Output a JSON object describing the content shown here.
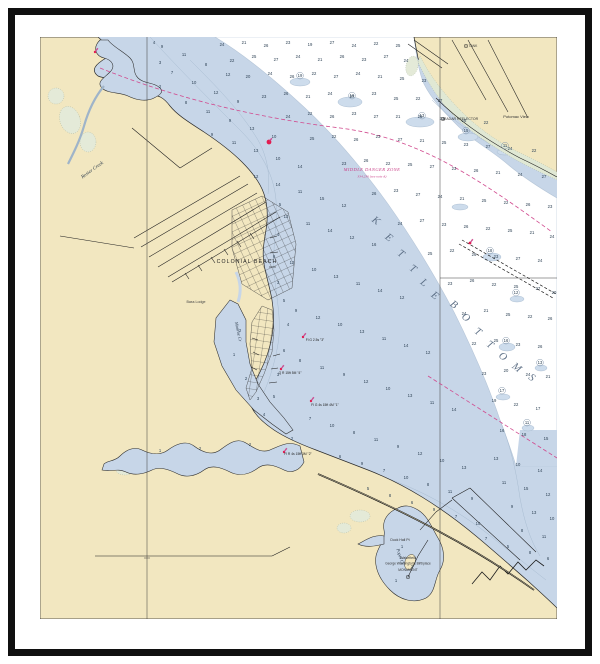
{
  "print": {
    "frame_color": "#101010",
    "mat_color": "#ffffff",
    "land_color": "#f2e7c0",
    "shallow_water_color": "#c7d6e8",
    "deep_water_color": "#ffffff",
    "marsh_color": "#e0e8d4",
    "magenta": "#c93f87",
    "red_aid": "#e31c4e"
  },
  "chart": {
    "labels": [
      {
        "t": "Rosier Creek",
        "x": 93,
        "y": 171,
        "r": -36,
        "s": 5,
        "c": "#2b3a4a",
        "f": "serif-i"
      },
      {
        "t": "COLONIAL BEACH",
        "x": 247,
        "y": 263,
        "r": 0,
        "s": 5.2,
        "c": "#222222",
        "f": "sans",
        "sp": 1.1
      },
      {
        "t": "Monroe Cr",
        "x": 237,
        "y": 332,
        "r": 78,
        "s": 4.5,
        "c": "#2b3a4a",
        "f": "serif-i"
      },
      {
        "t": "Bass Lodge",
        "x": 196,
        "y": 303,
        "r": 0,
        "s": 3.6,
        "c": "#444444",
        "f": "sans"
      },
      {
        "t": "MIDDLE DANGER ZONE",
        "x": 372,
        "y": 171,
        "r": 0,
        "s": 4.6,
        "c": "#c93f87",
        "f": "serif-i",
        "sp": 0.4
      },
      {
        "t": "334.230 (see note A)",
        "x": 372,
        "y": 177.5,
        "r": 0,
        "s": 3.5,
        "c": "#c93f87",
        "f": "serif-i"
      },
      {
        "t": "RADAR REFLECTOR",
        "x": 461,
        "y": 120,
        "r": 0,
        "s": 3.5,
        "c": "#333333",
        "f": "sans"
      },
      {
        "t": "Potomac View",
        "x": 516,
        "y": 118,
        "r": 0,
        "s": 4,
        "c": "#333333",
        "f": "sans"
      },
      {
        "t": "TANK",
        "x": 473,
        "y": 47,
        "r": 0,
        "s": 3.3,
        "c": "#333333",
        "f": "sans"
      },
      {
        "t": "Duck Hall Pt",
        "x": 400,
        "y": 541,
        "r": 0,
        "s": 3.5,
        "c": "#333333",
        "f": "sans"
      },
      {
        "t": "Wakefield",
        "x": 408,
        "y": 559,
        "r": 0,
        "s": 3.7,
        "c": "#333333",
        "f": "sans"
      },
      {
        "t": "George Washington's Birthplace",
        "x": 408,
        "y": 564.5,
        "r": 0,
        "s": 3.2,
        "c": "#333333",
        "f": "sans"
      },
      {
        "t": "MONUMENT",
        "x": 408,
        "y": 571,
        "r": 0,
        "s": 3.3,
        "c": "#333333",
        "f": "sans"
      },
      {
        "t": "Popes Cr",
        "x": 399,
        "y": 557,
        "r": 72,
        "s": 4.4,
        "c": "#2b3a4a",
        "f": "serif-i"
      },
      {
        "t": "Q R 15ft 5M \"4\"",
        "x": 290,
        "y": 374,
        "r": 0,
        "s": 3.3,
        "c": "#222222",
        "f": "sans"
      },
      {
        "t": "Fl G 4s 15ft 4M \"1\"",
        "x": 325,
        "y": 406,
        "r": 0,
        "s": 3.3,
        "c": "#222222",
        "f": "sans"
      },
      {
        "t": "Fl R 4s 15ft 3M \"2\"",
        "x": 298,
        "y": 455,
        "r": 0,
        "s": 3.3,
        "c": "#222222",
        "f": "sans"
      },
      {
        "t": "Fl G 2.5s \"3\"",
        "x": 315,
        "y": 341,
        "r": 0,
        "s": 3.3,
        "c": "#222222",
        "f": "sans"
      }
    ],
    "kettle": {
      "text": "KETTLE BOTTOMS",
      "size": 10.5,
      "rot": 38,
      "color": "#54677e",
      "letters": [
        [
          "K",
          374,
          223
        ],
        [
          "E",
          387,
          240
        ],
        [
          "T",
          399,
          256
        ],
        [
          "T",
          411,
          271
        ],
        [
          "L",
          422,
          285
        ],
        [
          "E",
          433,
          298
        ],
        [
          "B",
          452,
          307
        ],
        [
          "O",
          464,
          320
        ],
        [
          "T",
          476,
          334
        ],
        [
          "T",
          488,
          347
        ],
        [
          "O",
          501,
          359
        ],
        [
          "M",
          515,
          370
        ],
        [
          "S",
          530,
          380
        ]
      ]
    },
    "soundings": [
      [
        222,
        46,
        "24"
      ],
      [
        244,
        44,
        "21"
      ],
      [
        266,
        47,
        "26"
      ],
      [
        288,
        44,
        "23"
      ],
      [
        310,
        46,
        "19"
      ],
      [
        332,
        44,
        "27"
      ],
      [
        354,
        47,
        "24"
      ],
      [
        376,
        45,
        "22"
      ],
      [
        398,
        47,
        "25"
      ],
      [
        232,
        62,
        "22"
      ],
      [
        254,
        58,
        "25"
      ],
      [
        276,
        61,
        "27"
      ],
      [
        298,
        58,
        "24"
      ],
      [
        320,
        61,
        "21"
      ],
      [
        342,
        58,
        "26"
      ],
      [
        364,
        61,
        "23"
      ],
      [
        386,
        58,
        "27"
      ],
      [
        406,
        62,
        "24"
      ],
      [
        248,
        78,
        "20"
      ],
      [
        270,
        75,
        "24"
      ],
      [
        292,
        78,
        "26"
      ],
      [
        314,
        75,
        "22"
      ],
      [
        336,
        78,
        "27"
      ],
      [
        358,
        75,
        "24"
      ],
      [
        380,
        78,
        "21"
      ],
      [
        402,
        80,
        "25"
      ],
      [
        424,
        82,
        "23"
      ],
      [
        264,
        98,
        "23"
      ],
      [
        286,
        95,
        "26"
      ],
      [
        308,
        98,
        "21"
      ],
      [
        330,
        95,
        "24"
      ],
      [
        352,
        98,
        "27"
      ],
      [
        374,
        95,
        "23"
      ],
      [
        396,
        100,
        "25"
      ],
      [
        418,
        100,
        "22"
      ],
      [
        440,
        102,
        "27"
      ],
      [
        288,
        118,
        "24"
      ],
      [
        310,
        115,
        "22"
      ],
      [
        332,
        118,
        "26"
      ],
      [
        354,
        115,
        "23"
      ],
      [
        376,
        118,
        "27"
      ],
      [
        398,
        118,
        "21"
      ],
      [
        420,
        118,
        "25"
      ],
      [
        442,
        120,
        "23"
      ],
      [
        464,
        122,
        "26"
      ],
      [
        486,
        124,
        "22"
      ],
      [
        312,
        140,
        "25"
      ],
      [
        334,
        138,
        "22"
      ],
      [
        356,
        141,
        "26"
      ],
      [
        378,
        138,
        "23"
      ],
      [
        400,
        141,
        "27"
      ],
      [
        422,
        142,
        "21"
      ],
      [
        444,
        144,
        "25"
      ],
      [
        466,
        146,
        "23"
      ],
      [
        488,
        148,
        "27"
      ],
      [
        510,
        150,
        "24"
      ],
      [
        534,
        152,
        "22"
      ],
      [
        344,
        165,
        "23"
      ],
      [
        366,
        162,
        "26"
      ],
      [
        388,
        165,
        "22"
      ],
      [
        410,
        166,
        "25"
      ],
      [
        432,
        168,
        "27"
      ],
      [
        454,
        170,
        "23"
      ],
      [
        476,
        172,
        "26"
      ],
      [
        498,
        174,
        "21"
      ],
      [
        520,
        176,
        "24"
      ],
      [
        544,
        178,
        "27"
      ],
      [
        374,
        195,
        "26"
      ],
      [
        396,
        192,
        "23"
      ],
      [
        418,
        196,
        "27"
      ],
      [
        440,
        198,
        "24"
      ],
      [
        462,
        200,
        "21"
      ],
      [
        484,
        202,
        "25"
      ],
      [
        506,
        204,
        "22"
      ],
      [
        528,
        206,
        "26"
      ],
      [
        550,
        208,
        "23"
      ],
      [
        400,
        225,
        "24"
      ],
      [
        422,
        222,
        "27"
      ],
      [
        444,
        226,
        "23"
      ],
      [
        466,
        228,
        "26"
      ],
      [
        488,
        230,
        "22"
      ],
      [
        510,
        232,
        "25"
      ],
      [
        532,
        234,
        "21"
      ],
      [
        552,
        238,
        "24"
      ],
      [
        430,
        255,
        "25"
      ],
      [
        452,
        252,
        "22"
      ],
      [
        474,
        256,
        "26"
      ],
      [
        496,
        258,
        "23"
      ],
      [
        518,
        260,
        "27"
      ],
      [
        540,
        262,
        "24"
      ],
      [
        450,
        285,
        "23"
      ],
      [
        472,
        282,
        "26"
      ],
      [
        494,
        286,
        "22"
      ],
      [
        516,
        288,
        "25"
      ],
      [
        538,
        290,
        "27"
      ],
      [
        554,
        294,
        "20"
      ],
      [
        464,
        315,
        "24"
      ],
      [
        486,
        312,
        "21"
      ],
      [
        508,
        316,
        "25"
      ],
      [
        530,
        318,
        "22"
      ],
      [
        550,
        320,
        "26"
      ],
      [
        474,
        345,
        "22"
      ],
      [
        496,
        342,
        "25"
      ],
      [
        518,
        346,
        "23"
      ],
      [
        540,
        348,
        "26"
      ],
      [
        484,
        375,
        "23"
      ],
      [
        506,
        372,
        "20"
      ],
      [
        528,
        376,
        "24"
      ],
      [
        548,
        378,
        "21"
      ],
      [
        494,
        402,
        "19"
      ],
      [
        516,
        406,
        "22"
      ],
      [
        538,
        410,
        "17"
      ],
      [
        502,
        432,
        "16"
      ],
      [
        524,
        436,
        "18"
      ],
      [
        546,
        440,
        "15"
      ],
      [
        162,
        48,
        "9"
      ],
      [
        184,
        56,
        "11"
      ],
      [
        206,
        66,
        "8"
      ],
      [
        228,
        76,
        "12"
      ],
      [
        172,
        74,
        "7"
      ],
      [
        194,
        84,
        "10"
      ],
      [
        216,
        94,
        "12"
      ],
      [
        238,
        103,
        "9"
      ],
      [
        186,
        104,
        "8"
      ],
      [
        208,
        113,
        "11"
      ],
      [
        230,
        122,
        "9"
      ],
      [
        252,
        130,
        "13"
      ],
      [
        274,
        138,
        "10"
      ],
      [
        212,
        136,
        "9"
      ],
      [
        234,
        144,
        "11"
      ],
      [
        256,
        152,
        "13"
      ],
      [
        278,
        160,
        "10"
      ],
      [
        300,
        168,
        "14"
      ],
      [
        256,
        178,
        "12"
      ],
      [
        278,
        186,
        "14"
      ],
      [
        300,
        193,
        "11"
      ],
      [
        322,
        200,
        "15"
      ],
      [
        344,
        207,
        "12"
      ],
      [
        286,
        218,
        "13"
      ],
      [
        308,
        225,
        "11"
      ],
      [
        330,
        232,
        "14"
      ],
      [
        352,
        239,
        "12"
      ],
      [
        374,
        246,
        "16"
      ],
      [
        292,
        264,
        "12"
      ],
      [
        314,
        271,
        "10"
      ],
      [
        336,
        278,
        "13"
      ],
      [
        358,
        285,
        "11"
      ],
      [
        380,
        292,
        "14"
      ],
      [
        402,
        299,
        "12"
      ],
      [
        296,
        312,
        "9"
      ],
      [
        318,
        319,
        "12"
      ],
      [
        340,
        326,
        "10"
      ],
      [
        362,
        333,
        "13"
      ],
      [
        384,
        340,
        "11"
      ],
      [
        406,
        347,
        "14"
      ],
      [
        428,
        354,
        "12"
      ],
      [
        300,
        362,
        "8"
      ],
      [
        322,
        369,
        "11"
      ],
      [
        344,
        376,
        "9"
      ],
      [
        366,
        383,
        "12"
      ],
      [
        388,
        390,
        "10"
      ],
      [
        410,
        397,
        "13"
      ],
      [
        432,
        404,
        "11"
      ],
      [
        454,
        411,
        "14"
      ],
      [
        310,
        420,
        "7"
      ],
      [
        332,
        427,
        "10"
      ],
      [
        354,
        434,
        "8"
      ],
      [
        376,
        441,
        "11"
      ],
      [
        398,
        448,
        "9"
      ],
      [
        420,
        455,
        "12"
      ],
      [
        442,
        462,
        "10"
      ],
      [
        464,
        469,
        "13"
      ],
      [
        340,
        458,
        "6"
      ],
      [
        362,
        465,
        "9"
      ],
      [
        384,
        472,
        "7"
      ],
      [
        406,
        479,
        "10"
      ],
      [
        428,
        486,
        "8"
      ],
      [
        450,
        493,
        "11"
      ],
      [
        472,
        500,
        "9"
      ],
      [
        368,
        490,
        "5"
      ],
      [
        390,
        497,
        "8"
      ],
      [
        412,
        504,
        "6"
      ],
      [
        434,
        511,
        "9"
      ],
      [
        456,
        518,
        "7"
      ],
      [
        478,
        525,
        "10"
      ],
      [
        486,
        540,
        "7"
      ],
      [
        508,
        548,
        "5"
      ],
      [
        530,
        554,
        "8"
      ],
      [
        548,
        560,
        "6"
      ],
      [
        496,
        460,
        "13"
      ],
      [
        518,
        466,
        "10"
      ],
      [
        540,
        472,
        "14"
      ],
      [
        504,
        484,
        "11"
      ],
      [
        526,
        490,
        "15"
      ],
      [
        548,
        496,
        "12"
      ],
      [
        512,
        508,
        "9"
      ],
      [
        534,
        514,
        "13"
      ],
      [
        552,
        520,
        "10"
      ],
      [
        522,
        532,
        "8"
      ],
      [
        544,
        538,
        "11"
      ],
      [
        280,
        206,
        "5"
      ],
      [
        278,
        236,
        "4"
      ],
      [
        274,
        258,
        "6"
      ],
      [
        278,
        284,
        "3"
      ],
      [
        284,
        302,
        "5"
      ],
      [
        288,
        326,
        "4"
      ],
      [
        284,
        352,
        "6"
      ],
      [
        278,
        376,
        "3"
      ],
      [
        274,
        398,
        "5"
      ],
      [
        264,
        416,
        "4"
      ],
      [
        292,
        440,
        "2"
      ],
      [
        154,
        44,
        "4"
      ],
      [
        160,
        64,
        "3"
      ],
      [
        160,
        88,
        "2"
      ],
      [
        240,
        332,
        "2"
      ],
      [
        234,
        356,
        "1"
      ],
      [
        246,
        380,
        "2"
      ],
      [
        258,
        400,
        "3"
      ],
      [
        160,
        452,
        "1"
      ],
      [
        200,
        450,
        "2"
      ],
      [
        250,
        446,
        "2"
      ],
      [
        402,
        548,
        "1"
      ],
      [
        412,
        568,
        "2"
      ],
      [
        396,
        582,
        "1"
      ]
    ],
    "circled_soundings": [
      [
        300,
        77,
        "19"
      ],
      [
        352,
        97,
        "16"
      ],
      [
        422,
        117,
        "13"
      ],
      [
        466,
        132,
        "15"
      ],
      [
        505,
        147,
        "11"
      ],
      [
        490,
        252,
        "18"
      ],
      [
        516,
        294,
        "12"
      ],
      [
        506,
        342,
        "16"
      ],
      [
        540,
        364,
        "13"
      ],
      [
        502,
        392,
        "17"
      ],
      [
        527,
        424,
        "11"
      ]
    ],
    "red_dots": [
      {
        "x": 269,
        "y": 142,
        "r": 2.4
      },
      {
        "x": 470,
        "y": 243,
        "r": 1.4
      },
      {
        "x": 303,
        "y": 337,
        "r": 1.2
      },
      {
        "x": 281,
        "y": 369,
        "r": 1.2
      },
      {
        "x": 311,
        "y": 401,
        "r": 1.2
      },
      {
        "x": 284,
        "y": 452,
        "r": 1.2
      },
      {
        "x": 95,
        "y": 52,
        "r": 1.2
      }
    ],
    "landmark_circles": [
      {
        "x": 443,
        "y": 119
      },
      {
        "x": 466,
        "y": 46
      },
      {
        "x": 408,
        "y": 577
      }
    ]
  }
}
